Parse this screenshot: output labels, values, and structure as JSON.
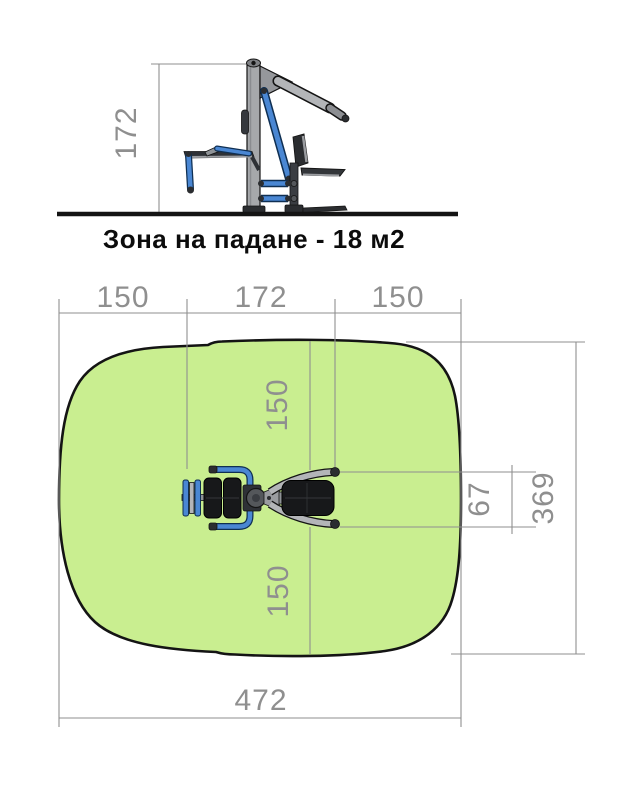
{
  "caption": {
    "text": "Зона на падане - 18 м2"
  },
  "elevation_view": {
    "height_dim": "172"
  },
  "plan_view": {
    "top_dimensions": {
      "left_clearance": "150",
      "equipment_length": "172",
      "right_clearance": "150"
    },
    "vertical_dimensions": {
      "top_clearance": "150",
      "bottom_clearance": "150",
      "equipment_depth": "67",
      "zone_depth": "369"
    },
    "bottom_dimension": {
      "zone_width": "472"
    }
  },
  "colors": {
    "fall_zone_fill": "#c9ee90",
    "zone_outline": "#141414",
    "dimension_gray": "#8f8f8f",
    "equipment_blue": "#4a87d3",
    "equipment_blue_dark": "#0f2f52",
    "equipment_gray": "#b3b5b8",
    "pad_black": "#17181a",
    "ground_black": "#141414"
  }
}
